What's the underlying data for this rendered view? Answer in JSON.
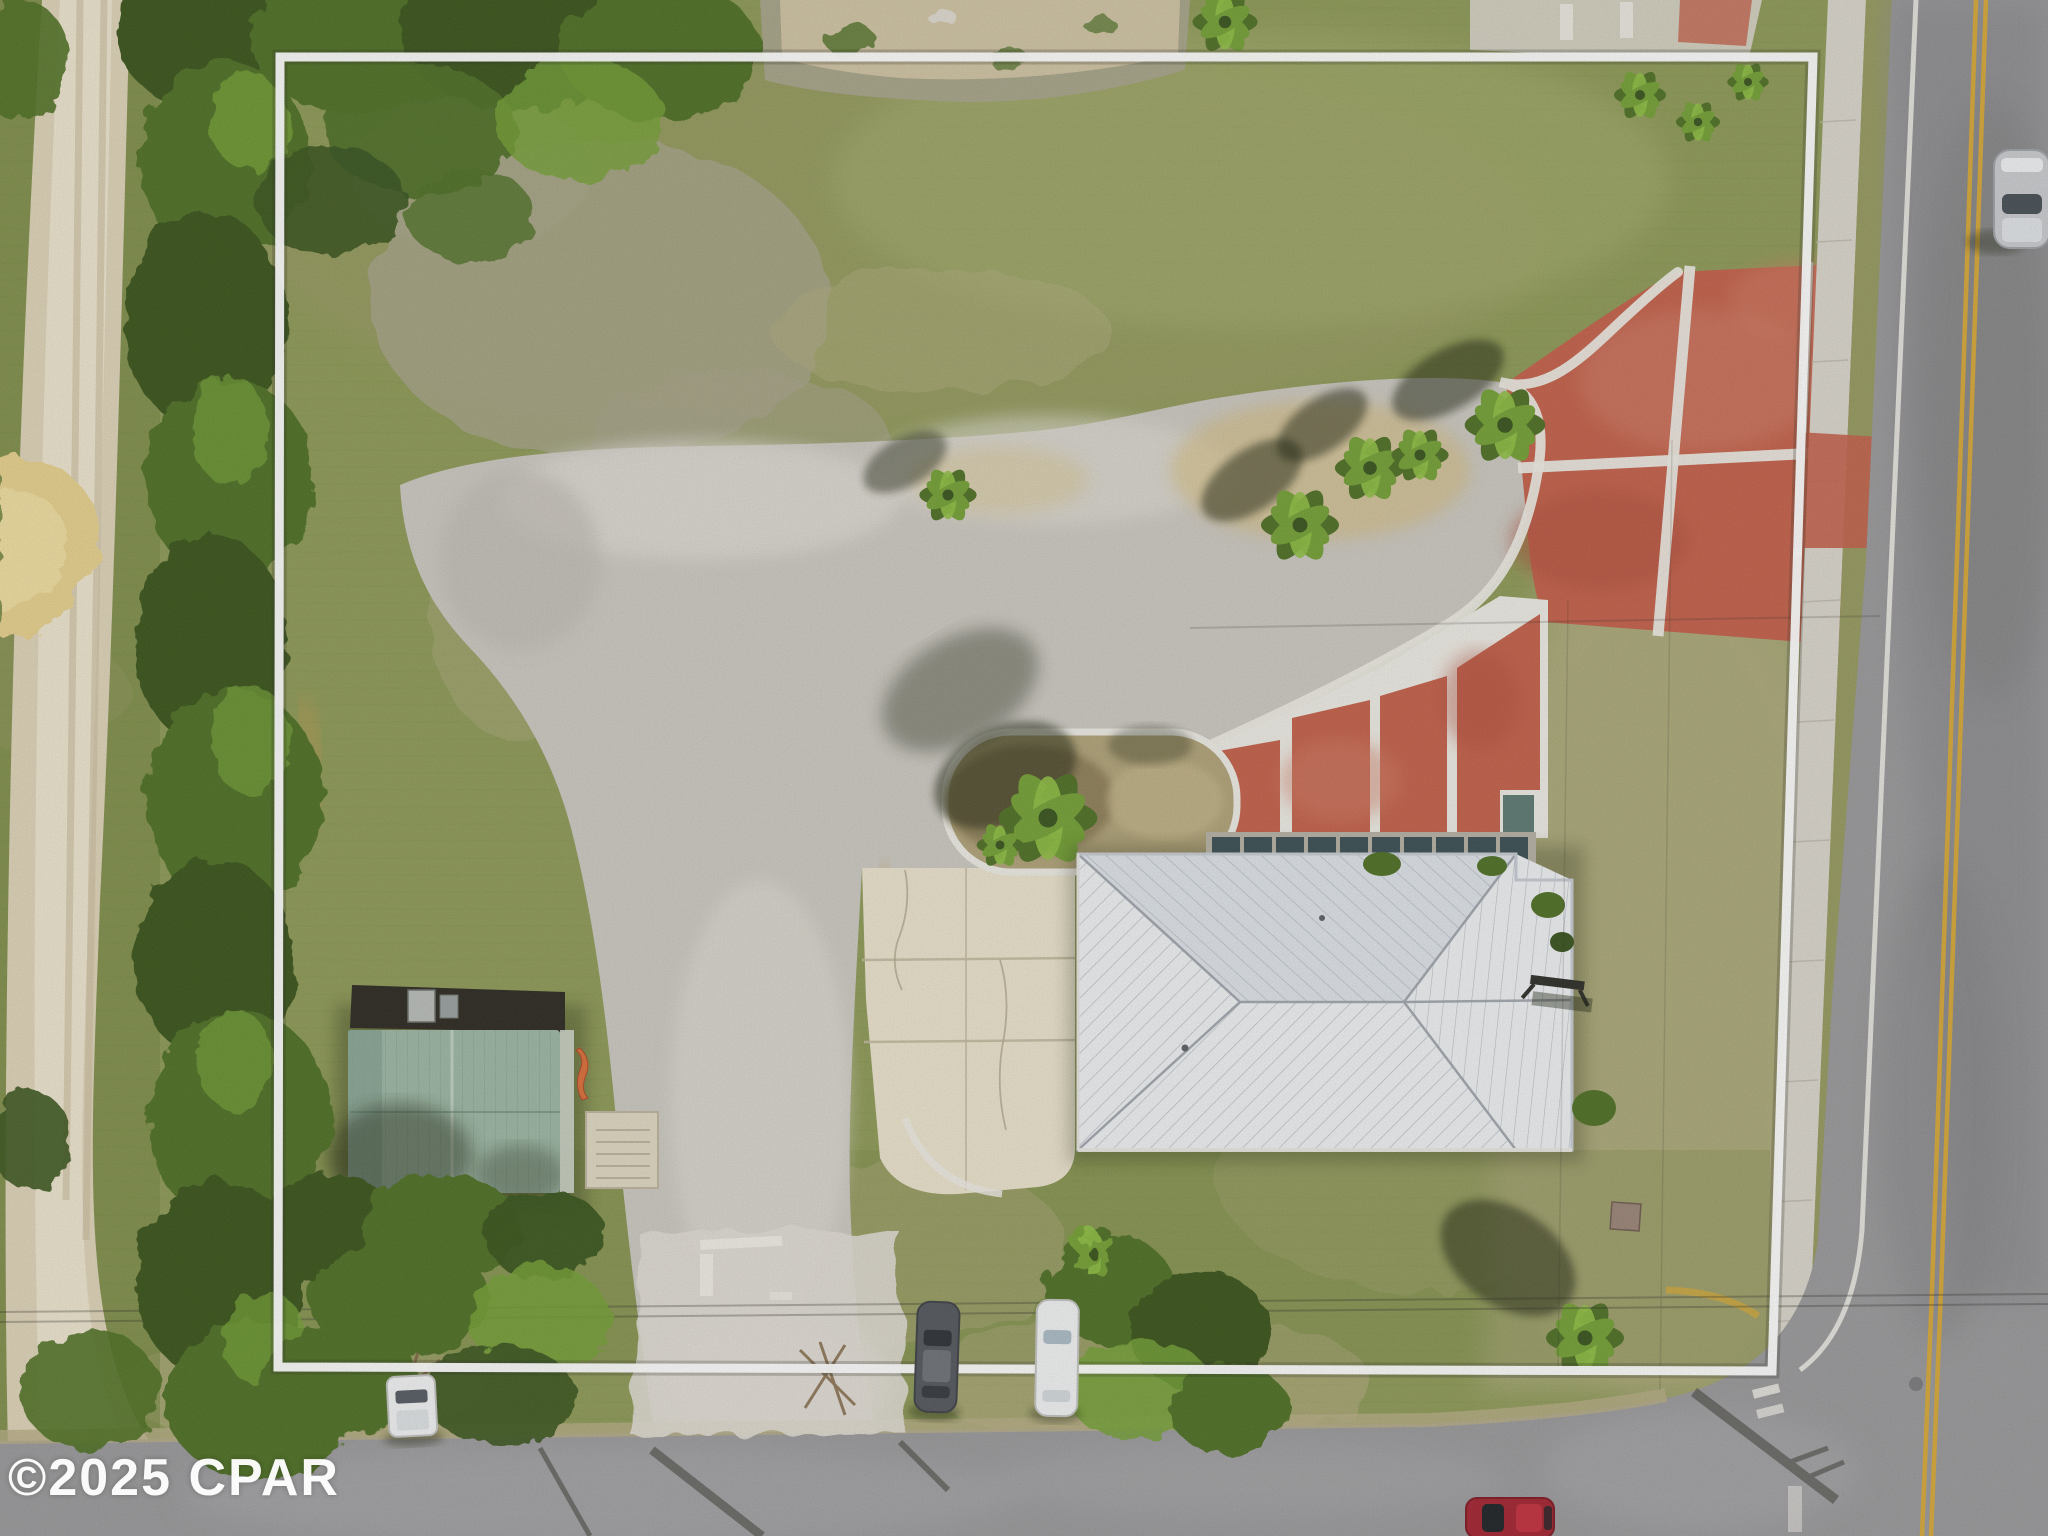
{
  "watermark": {
    "text": "©2025 CPAR"
  },
  "scene_label": "aerial-drone-photo-of-property-with-boundary-overlay",
  "colors": {
    "grassBase": "#8e9a58",
    "grassLight": "#a3ab6c",
    "grassDry": "#aeab7e",
    "grassDark": "#74833f",
    "grassOlive": "#969a60",
    "treeDark": "#3a541f",
    "treeMid": "#4f7026",
    "treeLight": "#74a036",
    "treeHi": "#8fbf45",
    "dirtRoad": "#ded3b8",
    "dirtRoadHi": "#efe8d3",
    "dirtTrack": "#c9bc9c",
    "sandPile": "#e6d08d",
    "bareDirt": "#a7a489",
    "tanDirt": "#b7ad85",
    "gravel": "#cbc8c1",
    "gravelHi": "#e0dcd4",
    "gravelStain": "#d09a4e",
    "stainYellow": "#d8b969",
    "creamConcrete": "#eae2cc",
    "jointLine": "#c2b89e",
    "sidewalk": "#d9d5cb",
    "sidewalkJoint": "#bcb7aa",
    "asphaltEast": "#8d8d90",
    "asphaltSouth": "#9a999b",
    "asphaltLight": "#a8a7aa",
    "asphaltDark": "#7b7b7e",
    "roadYellow": "#d9a934",
    "lineWhite": "#eceae3",
    "redPave": "#c3614b",
    "redPaveHi": "#d07f67",
    "redPaveLo": "#b24e3b",
    "roofWhite": "#edeff1",
    "roofShade": "#dde2e7",
    "roofSeam": "#aab1ba",
    "roofEdge": "#c6cbd2",
    "roofGreen": "#9cb6a4",
    "roofGreenShade": "#84a090",
    "roofGreenLine": "#5f7f6e",
    "roofDark": "#2e2a23",
    "awning": "#3c4f54",
    "awningFrame": "#b5b0a4",
    "teal": "#5d7a72",
    "padConcrete": "#ded7c2",
    "boundaryWhite": "#ffffff",
    "carSilver": "#c9cbce",
    "carWhite": "#f0f1f2",
    "carDark": "#54585e",
    "carRed": "#a32532",
    "glassDark": "#39424a",
    "shadow": "#1c2410",
    "wire": "#2c2c26",
    "flagOrange": "#d96f3a",
    "watermarkWhite": "#ffffff"
  },
  "inventory": [
    {
      "name": "property-boundary-outline",
      "label": "white property line overlay"
    },
    {
      "name": "main-building-roof",
      "label": "white standing-seam hip roof building"
    },
    {
      "name": "awning-row",
      "label": "row of dark window awnings"
    },
    {
      "name": "outbuilding-green-roof",
      "label": "green metal roof outbuilding"
    },
    {
      "name": "red-driveway",
      "label": "red paved driveway with white joint lines"
    },
    {
      "name": "red-parking-panels",
      "label": "red paved parking spaces"
    },
    {
      "name": "gravel-driveway",
      "label": "gravel drive and parking area"
    },
    {
      "name": "concrete-apron",
      "label": "cream concrete walkway"
    },
    {
      "name": "landscape-island",
      "label": "curbed landscape island with palms"
    },
    {
      "name": "tree-line-west",
      "label": "dense tree line on west side"
    },
    {
      "name": "dirt-road-west",
      "label": "dirt road on far west"
    },
    {
      "name": "sand-pile",
      "label": "sand mound beside dirt road"
    },
    {
      "name": "road-east",
      "label": "asphalt road with double yellow line"
    },
    {
      "name": "road-south",
      "label": "asphalt road along south edge"
    },
    {
      "name": "car-silver-moving",
      "label": "silver car driving on east road"
    },
    {
      "name": "car-dark-parked",
      "label": "dark sedan parked at south edge"
    },
    {
      "name": "car-white-parked",
      "label": "white car parked at south edge"
    },
    {
      "name": "truck-white-parked",
      "label": "white truck parked at south-west"
    },
    {
      "name": "car-red-parked",
      "label": "red car at bottom right"
    },
    {
      "name": "palm-tree",
      "label": "palm trees with shadows"
    },
    {
      "name": "copyright-watermark",
      "label": "©2025 CPAR"
    }
  ]
}
